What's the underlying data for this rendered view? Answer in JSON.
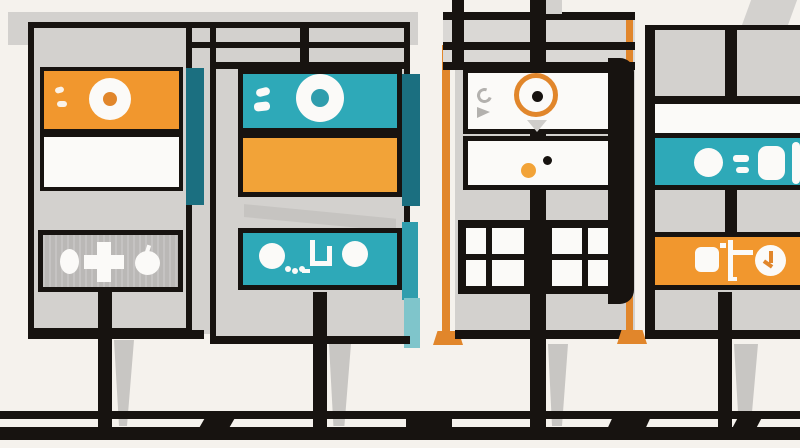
{
  "scene": {
    "type": "flat-vector-illustration",
    "subject": "four-signboard-panels-on-posts",
    "colors": {
      "bg": "#F5F2ED",
      "black": "#171310",
      "band": "#D3D1CE",
      "cell": "#DAD8D5",
      "control": "#BAB8B6",
      "shadow": "#C8C6C3",
      "white": "#FBFAF8",
      "orange": "#F1972E",
      "orange2": "#F2A338",
      "orange_deep": "#E1862B",
      "teal": "#2EA9B8",
      "teal_dark": "#1B6F80",
      "teal_mid": "#2F9DAD",
      "teal_light": "#7FC5CB"
    },
    "panels": [
      {
        "name": "panel-1",
        "boxes": [
          "orange-lens-box",
          "white-blank-box",
          "gray-control-box"
        ],
        "icons": [
          "lens-donut-icon",
          "tick-marks-icon",
          "oval-dot-icon",
          "plus-icon",
          "apple-icon"
        ]
      },
      {
        "name": "panel-2",
        "boxes": [
          "teal-lens-box",
          "orange-blank-box",
          "teal-controls-box"
        ],
        "icons": [
          "lens-donut-icon",
          "dash-marks-icon",
          "circle-icon",
          "ellipsis-dots-icon",
          "bracket-icon",
          "circle-icon"
        ]
      },
      {
        "name": "panel-3",
        "boxes": [
          "white-target-box",
          "white-dots-box",
          "window-grid-box"
        ],
        "icons": [
          "target-ring-icon",
          "crescent-icon",
          "triangle-icon",
          "orange-dot-icon",
          "black-dot-icon"
        ],
        "grid": {
          "rows": 2,
          "cols": 4
        }
      },
      {
        "name": "panel-4",
        "boxes": [
          "white-strip",
          "teal-icon-strip",
          "orange-icon-strip"
        ],
        "icons": [
          "circle-icon",
          "equals-dash-icon",
          "rounded-rect-icon",
          "rounded-square-icon",
          "branch-bracket-icon",
          "clock-icon"
        ]
      }
    ],
    "ground": {
      "rails": 2,
      "posts": 4,
      "poles": 2
    }
  }
}
